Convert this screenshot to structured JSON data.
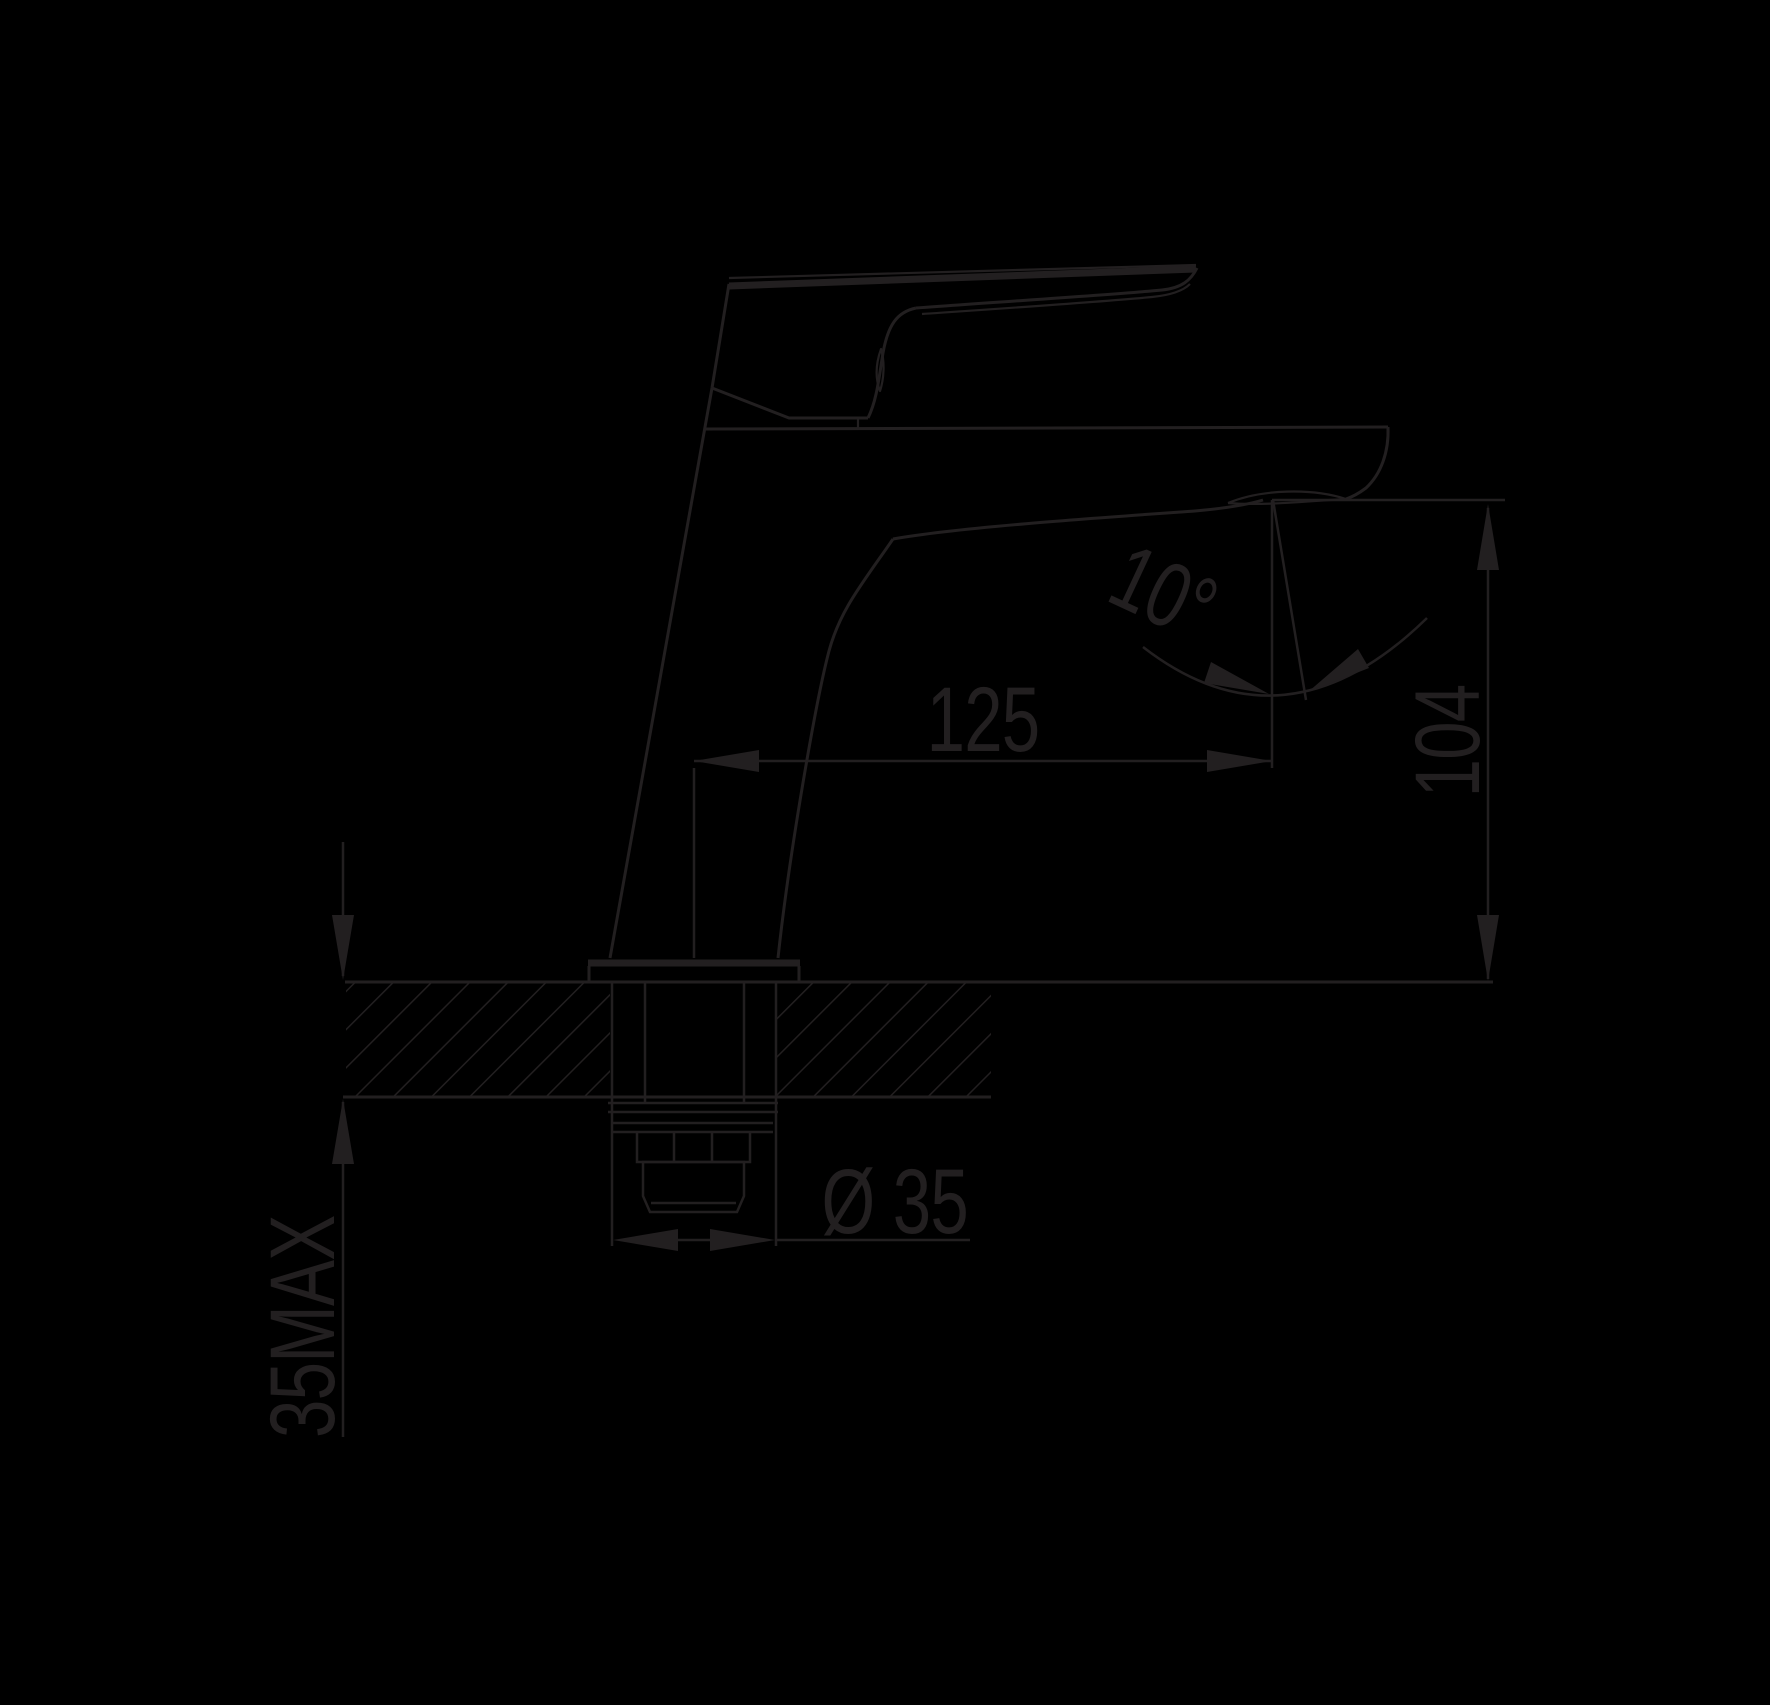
{
  "canvas": {
    "width": 1770,
    "height": 1705,
    "background": "#000000",
    "line_color": "#221f20"
  },
  "drawing_kind": "basin mixer tap side elevation with installation dimensions",
  "dimensions": {
    "spout_reach": "125",
    "spout_height": "104",
    "spout_angle": "10°",
    "shank_diameter": "Ø 35",
    "max_deck_thickness": "35MAX"
  }
}
